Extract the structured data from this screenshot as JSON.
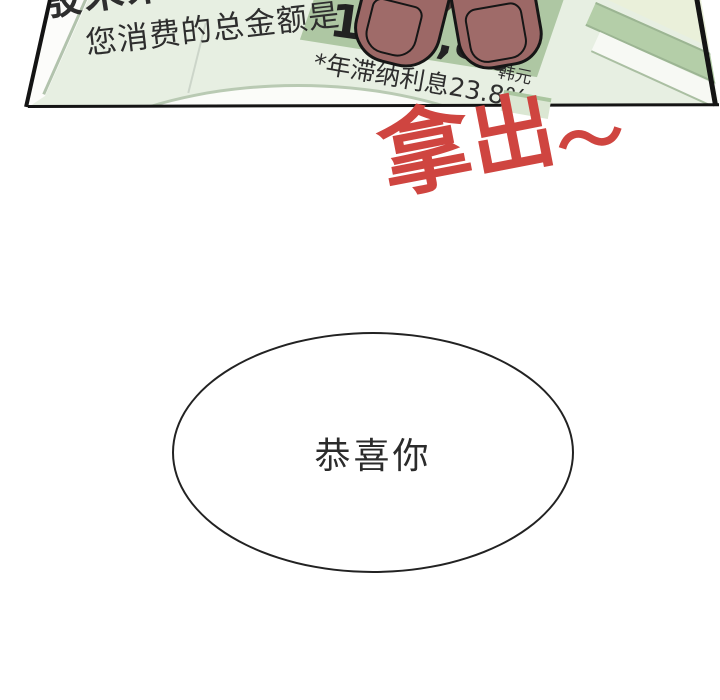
{
  "page": {
    "background_color": "#ffffff"
  },
  "panel": {
    "paper_color": "#e7efe2",
    "band_color": "#aec7a3",
    "border_color": "#141414",
    "finger_color": "#9c6866",
    "bill": {
      "recipient_line": "殷未来 女士",
      "subtitle": "您消费的总金额是",
      "amount_segments": [
        "15",
        "3,8",
        "0"
      ],
      "interest_note": "*年滞纳利息23.8%",
      "currency_unit": "韩元"
    }
  },
  "sfx": {
    "text": "拿出～",
    "chars": [
      "拿",
      "出",
      "～"
    ],
    "color": "#cf4540"
  },
  "speech_bubble": {
    "text": "恭喜你",
    "text_color": "#2b2b2b"
  }
}
